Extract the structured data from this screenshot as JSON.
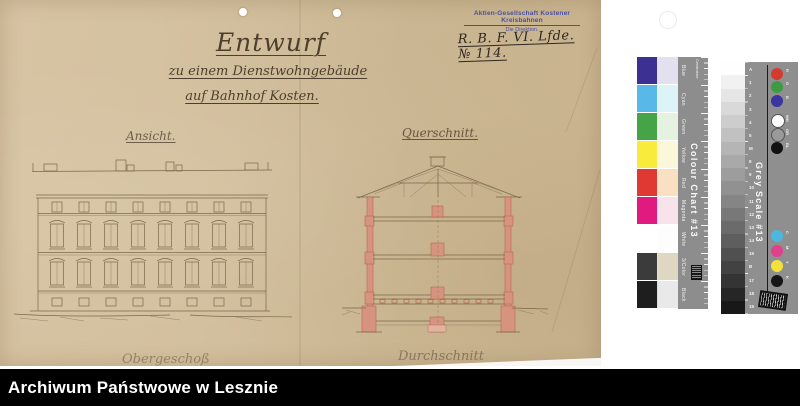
{
  "document": {
    "stamp": {
      "line1": "Aktien-Gesellschaft Kostener Kreisbahnen",
      "line2": "Die Direktion."
    },
    "file_notation": "R. B. F. VI. Lfde. № 114.",
    "title": "Entwurf",
    "subtitle1": "zu einem Dienstwohngebäude",
    "subtitle2": "auf Bahnhof Kosten.",
    "label_elevation": "Ansicht.",
    "label_section": "Querschnitt.",
    "label_bottom_left": "Obergeschoß",
    "label_bottom_right": "Durchschnitt"
  },
  "colour_chart": {
    "title": "Colour Chart #13",
    "scale_label": "Centimetre",
    "rows": [
      {
        "label": "Blue",
        "color": "#3c3192",
        "tint": "#e3e1ef"
      },
      {
        "label": "Cyan",
        "color": "#58b9e8",
        "tint": "#def3f6"
      },
      {
        "label": "Green",
        "color": "#46a347",
        "tint": "#e5f1e1"
      },
      {
        "label": "Yellow",
        "color": "#f9eb3c",
        "tint": "#fbf7da"
      },
      {
        "label": "Red",
        "color": "#e03833",
        "tint": "#f9e0c2"
      },
      {
        "label": "Magenta",
        "color": "#e11a7f",
        "tint": "#f8e3eb"
      },
      {
        "label": "White",
        "color": "#ffffff",
        "tint": "#fdfdfd"
      },
      {
        "label": "3/Color",
        "color": "#3b3b3b",
        "tint": "#ded7c1"
      },
      {
        "label": "Black",
        "color": "#1e1e1e",
        "tint": "#e9e9e9"
      }
    ]
  },
  "grey_scale": {
    "title": "Grey Scale #13",
    "steps": [
      "#fefefe",
      "#f1f1f1",
      "#e5e5e5",
      "#d9d9d9",
      "#cdcdcd",
      "#c1c1c1",
      "#b5b5b5",
      "#a9a9a9",
      "#9d9d9d",
      "#919191",
      "#858585",
      "#787878",
      "#6b6b6b",
      "#5e5e5e",
      "#505050",
      "#424242",
      "#343434",
      "#262626",
      "#181818"
    ],
    "ticks": [
      "A",
      "1",
      "2",
      "3",
      "4",
      "5",
      "M",
      "8",
      "9",
      "10",
      "11",
      "12",
      "13",
      "14",
      "15",
      "B",
      "17",
      "18",
      "19"
    ],
    "dots_top": [
      {
        "label": "R",
        "color": "#d23b2f"
      },
      {
        "label": "G",
        "color": "#3f9a45"
      },
      {
        "label": "B",
        "color": "#3c35a0"
      },
      {
        "label": "WH",
        "color": "#ffffff"
      },
      {
        "label": "GR",
        "color": "#9a9a9a"
      },
      {
        "label": "BL",
        "color": "#111111"
      }
    ],
    "dots_bottom": [
      {
        "label": "C",
        "color": "#4cb8e0"
      },
      {
        "label": "M",
        "color": "#e0418c"
      },
      {
        "label": "Y",
        "color": "#f2e33c"
      },
      {
        "label": "K",
        "color": "#161616"
      }
    ]
  },
  "footer": {
    "text": "Archiwum Państwowe w Lesznie"
  }
}
